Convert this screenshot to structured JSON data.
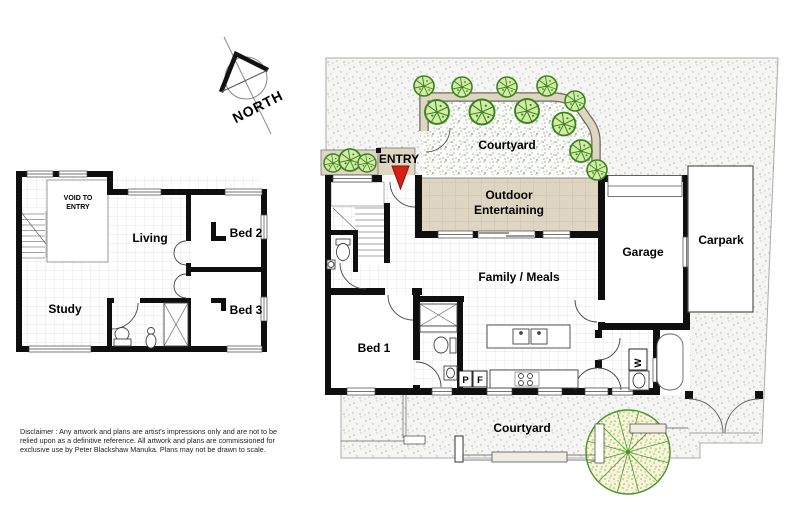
{
  "compass": {
    "label": "NORTH"
  },
  "upper_floor": {
    "void_line1": "VOID TO",
    "void_line2": "ENTRY",
    "living": "Living",
    "bed2": "Bed 2",
    "bed3": "Bed 3",
    "study": "Study"
  },
  "ground_floor": {
    "entry": "ENTRY",
    "courtyard_top": "Courtyard",
    "outdoor_line1": "Outdoor",
    "outdoor_line2": "Entertaining",
    "family_meals": "Family / Meals",
    "garage": "Garage",
    "carpark": "Carpark",
    "bed1": "Bed 1",
    "pantry_abbr": "P",
    "fridge_abbr": "F",
    "washer_abbr": "W",
    "courtyard_bottom": "Courtyard"
  },
  "disclaimer": {
    "line1": "Disclaimer : Any artwork and plans are artist's impressions only and are not to be",
    "line2": "relied upon as a definitive reference. All artwork and plans are commissioned for",
    "line3": "exclusive use by Peter Blackshaw Manuka. Plans may not be drawn to scale."
  },
  "colors": {
    "wall": "#0f0f0f",
    "paving_tan": "#ded6c2",
    "tree_green": "#39851d",
    "entry_arrow_red": "#d42015",
    "site_dot": "#b4b4ae"
  }
}
